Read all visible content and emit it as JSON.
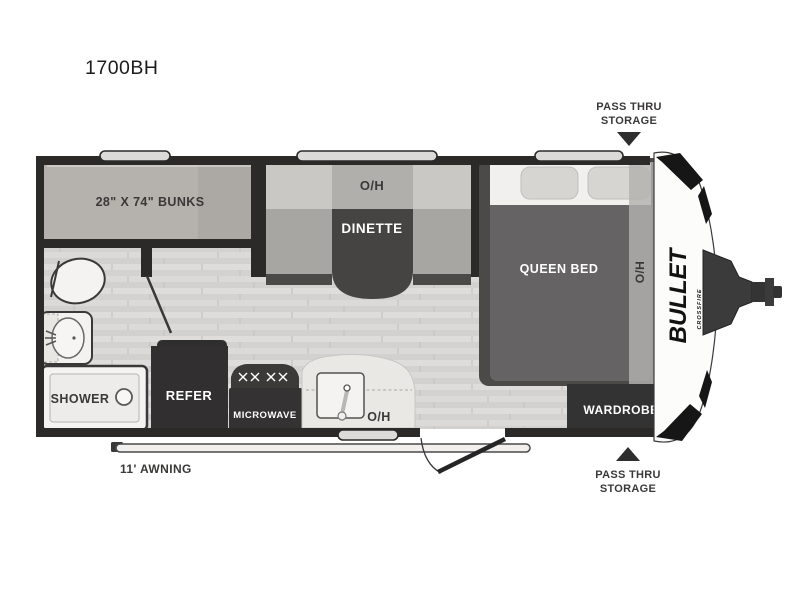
{
  "title": "1700BH",
  "labels": {
    "bunks": "28\" X 74\" BUNKS",
    "dinette_oh": "O/H",
    "dinette": "DINETTE",
    "queen_bed": "QUEEN BED",
    "bed_oh": "O/H",
    "shower": "SHOWER",
    "refer": "REFER",
    "microwave": "MICROWAVE",
    "kitchen_oh": "O/H",
    "wardrobe": "WARDROBE",
    "awning": "11' AWNING",
    "pass_thru_line1": "PASS THRU",
    "pass_thru_line2": "STORAGE"
  },
  "brand": {
    "name": "BULLET",
    "series": "CROSSFIRE"
  },
  "colors": {
    "wall": "#2b2a29",
    "floor_light": "#dedddc",
    "floor_dark": "#d2d1d0",
    "bunks_fill": "#b5b2ad",
    "bench_back": "#cac8c4",
    "bench_seat": "#a8a6a2",
    "table_dark": "#454443",
    "bed_body": "#656364",
    "dark_fixture": "#312f2f",
    "counter": "#eae8e5",
    "fixture_white": "#f4f3f1",
    "cap_white": "#fcfcfb"
  }
}
